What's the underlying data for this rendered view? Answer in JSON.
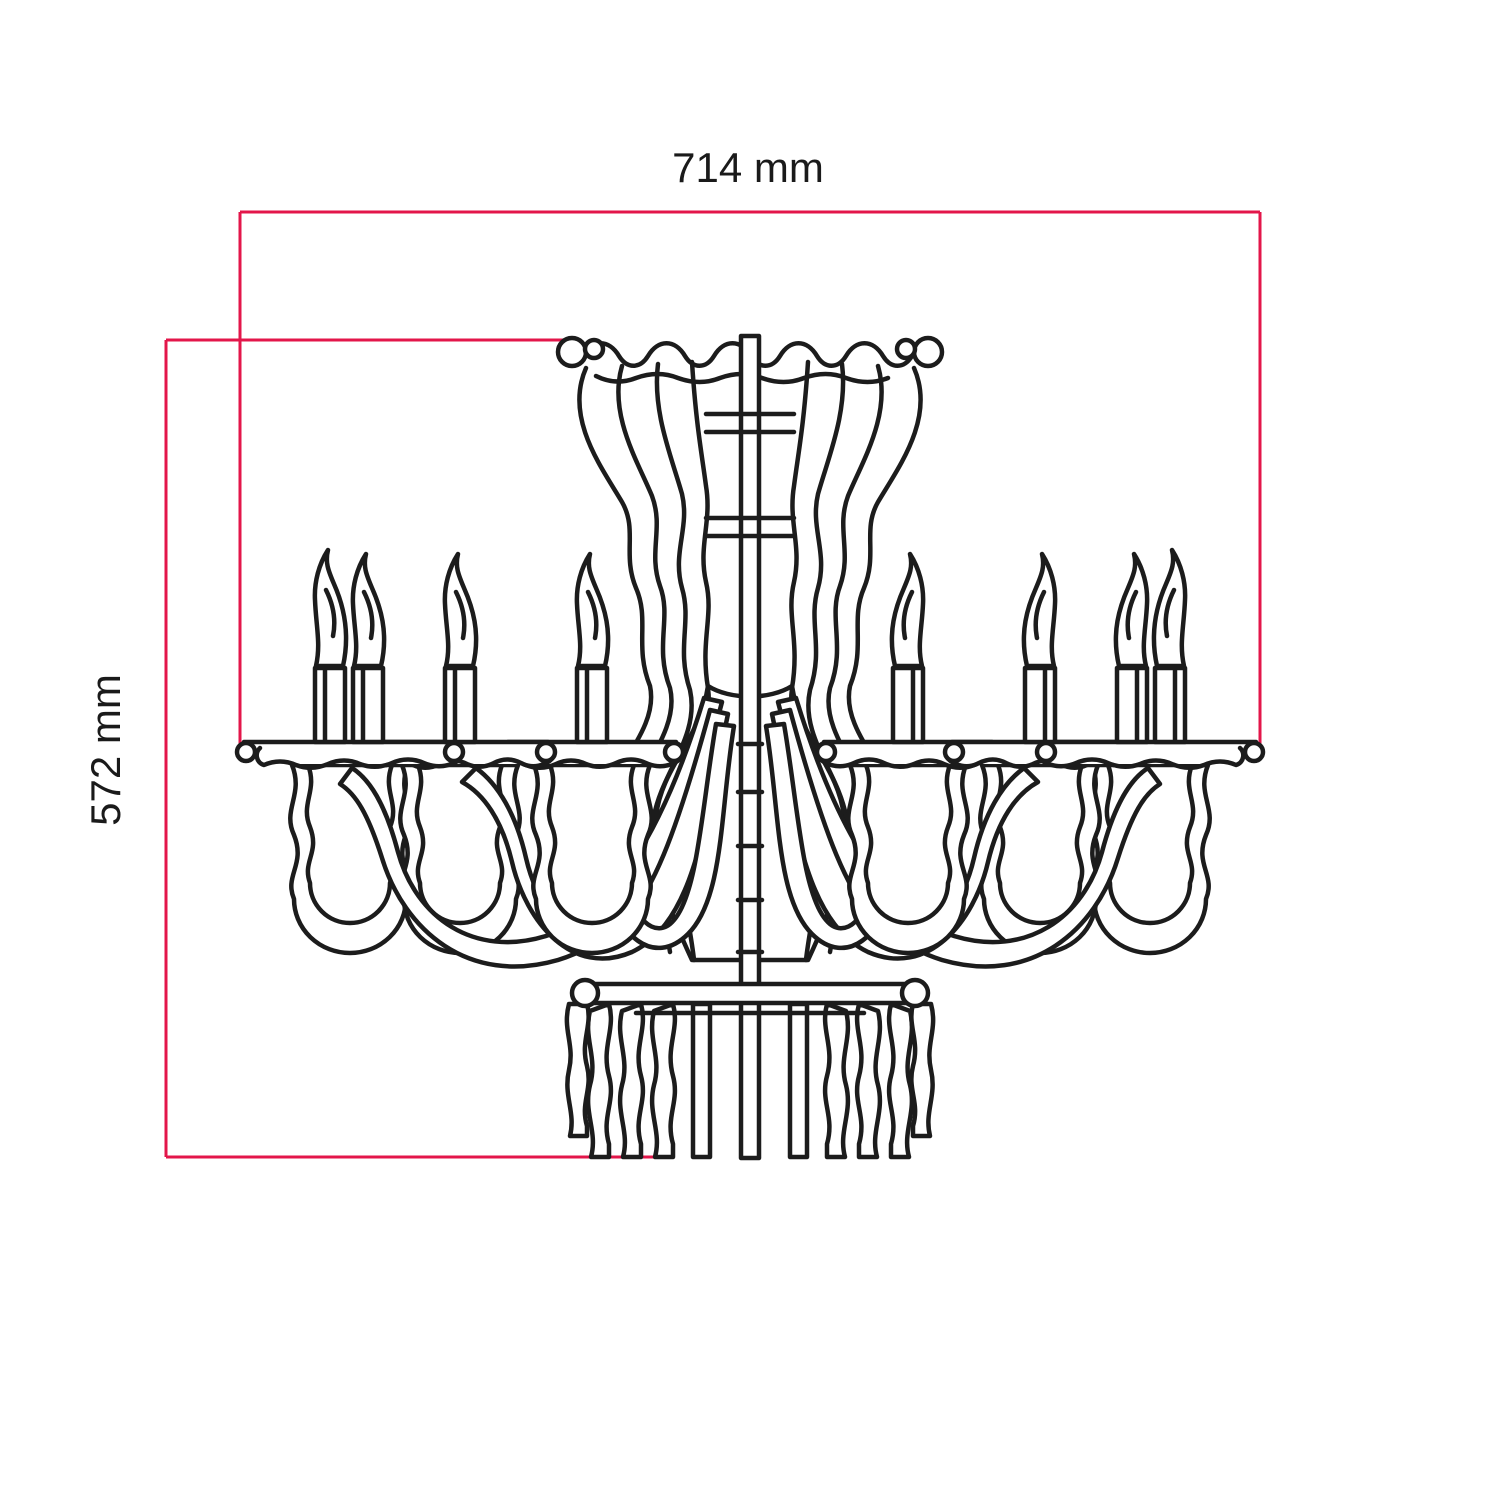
{
  "figure": {
    "kind": "technical dimension drawing",
    "subject": "chandelier elevation line drawing",
    "background_color": "#ffffff"
  },
  "dimensions": {
    "width": {
      "label": "714 mm",
      "value": 714,
      "unit": "mm",
      "orientation": "horizontal-top"
    },
    "height": {
      "label": "572 mm",
      "value": 572,
      "unit": "mm",
      "orientation": "vertical-left-rotated"
    }
  },
  "colors": {
    "dimension_line": "#e3164a",
    "drawing_line": "#1c1c1c",
    "label_text": "#1a1a1a"
  }
}
